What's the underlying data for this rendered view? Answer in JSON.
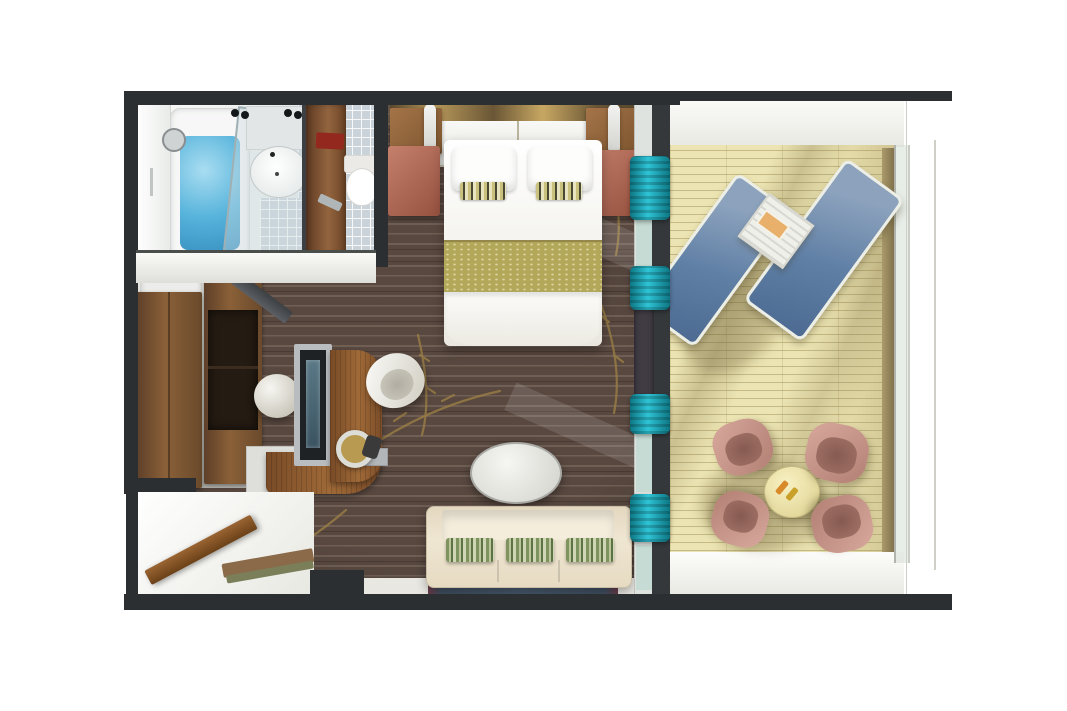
{
  "scene": {
    "title": "Cruise suite floor plan — 3D top-down rendering",
    "rooms": [
      {
        "id": "bathroom",
        "label": "Bathroom",
        "furniture": [
          "bathtub",
          "bath-water",
          "shower-glass-panel",
          "shower-head",
          "washbasin",
          "vanity-counter",
          "ceiling-spotlights",
          "tiled-floor",
          "toilet",
          "toilet-compartment-door",
          "toilet-paper-holder",
          "wall-cabinet"
        ]
      },
      {
        "id": "bedroom",
        "label": "Bedroom",
        "furniture": [
          "double-bed",
          "pillow-left",
          "pillow-right",
          "accent-pillow-left",
          "accent-pillow-right",
          "bed-runner",
          "headboard-light-band",
          "headboard-panel",
          "hanging-cabinet-left",
          "hanging-cabinet-right",
          "pendant-lamp-left",
          "pendant-lamp-right",
          "nightstand-left",
          "nightstand-right"
        ]
      },
      {
        "id": "dressing-area",
        "label": "Dressing area",
        "furniture": [
          "open-shelf-unit",
          "shelf-items-red",
          "shelf-items-dark",
          "wardrobe",
          "cabinet-open",
          "leaning-mirror"
        ]
      },
      {
        "id": "work-area",
        "label": "Work area",
        "furniture": [
          "tv-panel",
          "curved-desk",
          "desk-foot",
          "desk-lamp",
          "desk-speaker",
          "desk-chair",
          "ottoman-stool",
          "side-cabinet",
          "gray-shelf"
        ]
      },
      {
        "id": "living-area",
        "label": "Living area",
        "furniture": [
          "three-seat-sofa",
          "sofa-cushion-1",
          "sofa-cushion-2",
          "sofa-cushion-3",
          "oval-coffee-table",
          "blue-rug"
        ]
      },
      {
        "id": "entry",
        "label": "Entry",
        "furniture": [
          "entrance-door-open",
          "door-threshold",
          "bench-strips"
        ]
      },
      {
        "id": "balcony",
        "label": "Balcony",
        "furniture": [
          "wood-decking",
          "lounger-left",
          "lounger-right",
          "slatted-side-table",
          "book-on-table",
          "round-table",
          "drink-1",
          "drink-2",
          "chair-top-left",
          "chair-top-right",
          "chair-bottom-left",
          "chair-bottom-right",
          "glass-railing",
          "balcony-walls"
        ]
      }
    ]
  },
  "palette": {
    "wall_dark": "#2c2f31",
    "carpet_brown": "#584840",
    "carpet_vine_gold": "#9d8045",
    "deck_pale_wood": "#ece4b2",
    "curtain_teal": "#1ba7b5",
    "lounger_blue": "#5f7fa5",
    "balcony_chair_mauve": "#c49086",
    "sofa_cream": "#e9ddc6",
    "cushion_green": "#8fa06a",
    "bed_runner_gold": "#b3a75a",
    "nightstand_salmon": "#b0695a",
    "cabinet_wood": "#8a5f3a",
    "bath_water_blue": "#56b3db",
    "tile_gray_blue": "#c9d3d9",
    "rug_navy": "#46586b",
    "rug_trim_maroon": "#8a4a5a",
    "table_pale_yellow": "#e8dc9c",
    "white_surface": "#f4f4f2"
  }
}
